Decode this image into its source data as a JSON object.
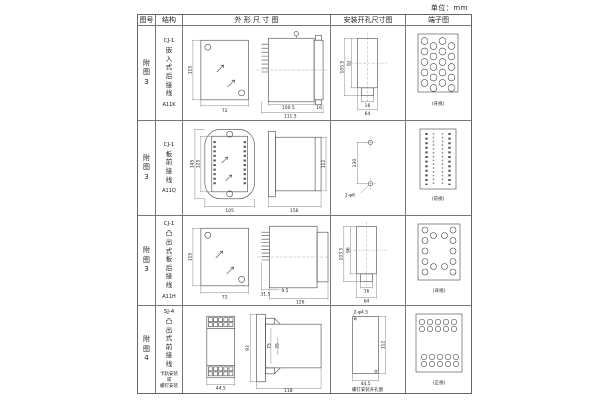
{
  "unit_label": "单位：mm",
  "header": {
    "figure_no": "图号",
    "structure": "结构",
    "outline": "外 形 尺 寸 图",
    "mounting": "安装开孔尺寸图",
    "terminal": "端子图"
  },
  "rows": [
    {
      "figure_no": "附图3",
      "structure": {
        "type": "CJ-1",
        "desc": "嵌入式后接线",
        "model": "A11K",
        "note": ""
      },
      "outline": {
        "front_height": "115",
        "front_width": "72",
        "side_len1": "100.5",
        "side_len2": "111.5",
        "side_small": "16"
      },
      "mounting": {
        "height1": "105.5",
        "height2": "92",
        "width_small": "16",
        "width": "64"
      },
      "terminal": {
        "caption": "(背视)"
      }
    },
    {
      "figure_no": "附图3",
      "structure": {
        "type": "CJ-1",
        "desc": "板前接线",
        "model": "A11Q",
        "note": ""
      },
      "outline": {
        "front_height1": "145",
        "front_height2": "125",
        "front_width": "105",
        "side_len": "156",
        "side_height": "112"
      },
      "mounting": {
        "spacing": "130",
        "holes": "2-φ6"
      },
      "terminal": {
        "caption": "(前视)"
      }
    },
    {
      "figure_no": "附图3",
      "structure": {
        "type": "CJ-1",
        "desc": "凸出式板后接线",
        "model": "A11H",
        "note": ""
      },
      "outline": {
        "front_height": "115",
        "front_width": "72",
        "side_pins": "31.5",
        "side_gap": "9.5",
        "side_len": "126"
      },
      "mounting": {
        "height1": "103.5",
        "height2": "96",
        "width_small": "16",
        "width": "64"
      },
      "terminal": {
        "caption": "(背视)"
      }
    },
    {
      "figure_no": "附图4",
      "structure": {
        "type": "SJ-4",
        "desc": "凸出式前接线",
        "model": "",
        "note": "卡轨安装\n或\n螺钉安装"
      },
      "outline": {
        "front_width": "44.5",
        "side_height": "93",
        "side_inner": "75",
        "side_small": "35",
        "side_len": "118"
      },
      "mounting": {
        "holes": "2-φ4.5",
        "height": "112",
        "width": "44.5",
        "caption": "螺钉安装开孔图"
      },
      "terminal": {
        "caption": "(正视)"
      }
    }
  ]
}
